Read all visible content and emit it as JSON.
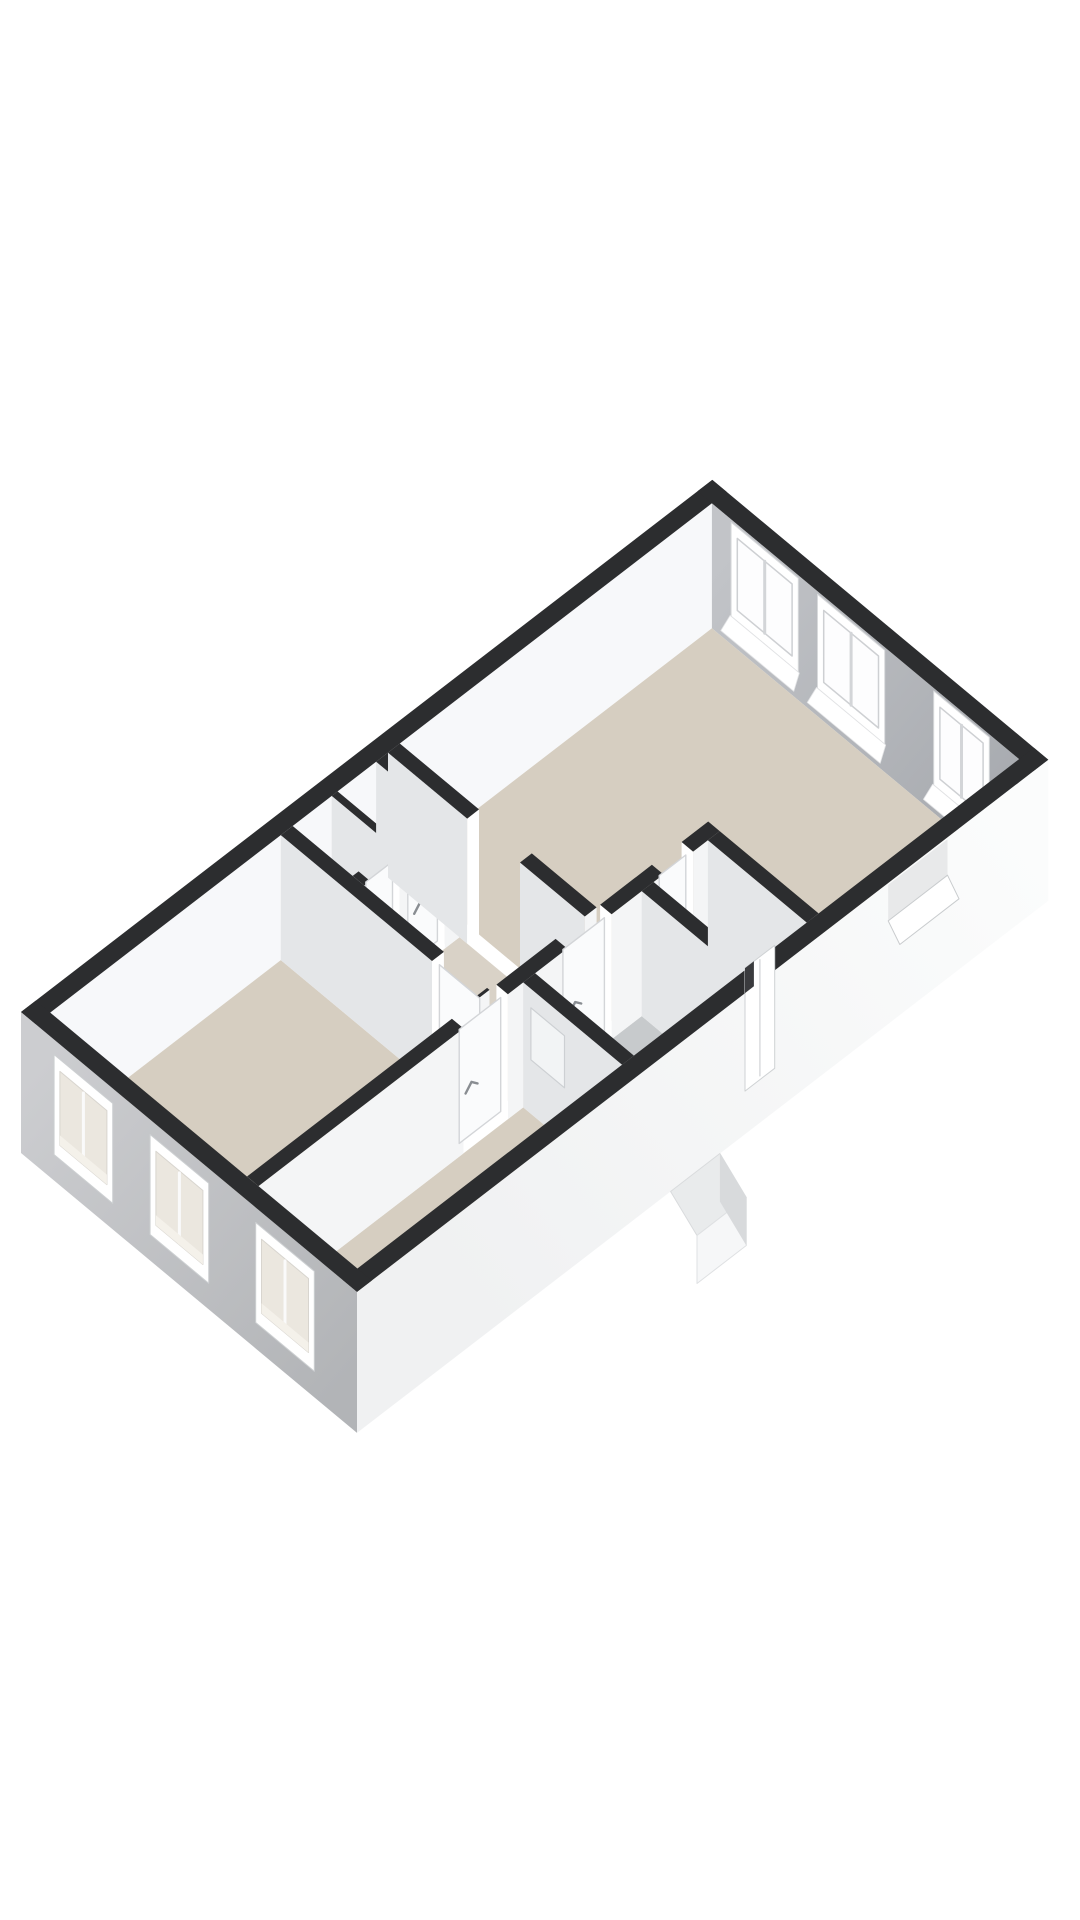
{
  "page": {
    "background": "#ffffff",
    "kind": "3d-floor-plan-render"
  },
  "scene": {
    "projection": {
      "origin": [
        21,
        1137
      ],
      "ux": [
        49.38,
        -38.01
      ],
      "vy": [
        48.0,
        39.98
      ]
    },
    "metrics": {
      "topZ": -125,
      "floorZ": 0,
      "extBottomZ": 16,
      "leafTop": -118,
      "leafBottom": -4
    },
    "colors": {
      "wallTop": "#2c2d2f",
      "nwFace": "#f7f8fa",
      "neFace": "#a6a9ae",
      "neFaceLight": "#c2c4c8",
      "swFace": "#b2b4b7",
      "swFaceLight": "#cccdd0",
      "seFace": "#fbfcfc",
      "seFaceShade": "#f0f1f2",
      "intFaceSE": "#f4f5f6",
      "intFaceSW": "#e4e6e8",
      "floorBeige": "#d6cec1",
      "floorHall": "#d9d2c7",
      "floorBath": "#c7cacc",
      "floorCloset": "#ededee",
      "glass": "#fdfdfe",
      "paneGlass": "#f2f4f5",
      "leaf": "#fafbfc",
      "leafLine": "#d3d5d8",
      "handle": "#898d92",
      "stepTop": "#e9ebec",
      "stepFace": "#f6f7f8",
      "stepSide": "#d8dadc",
      "swWinInner": "#ebe7df",
      "jamb": "#ffffff",
      "nicheBack": "#e8e9ea",
      "sill": "#ffffff"
    },
    "exterior": {
      "nw": {
        "u": [
          0,
          14
        ],
        "v": [
          0,
          0.3
        ]
      },
      "ne": {
        "u": [
          13.7,
          14
        ],
        "v": [
          0,
          7
        ]
      },
      "se": {
        "u": [
          0,
          14
        ],
        "v": [
          6.7,
          7.0
        ]
      },
      "sw": {
        "u": [
          0,
          0.3
        ],
        "v": [
          0,
          7
        ]
      }
    },
    "rooms": [
      {
        "name": "bedroom-1-floor",
        "color": "floorBeige",
        "poly": [
          [
            0.3,
            0.3
          ],
          [
            4.97,
            0.3
          ],
          [
            4.97,
            4.4
          ],
          [
            0.3,
            4.4
          ]
        ]
      },
      {
        "name": "closet-a-floor",
        "color": "floorCloset",
        "poly": [
          [
            5.21,
            0.3
          ],
          [
            6.0,
            0.3
          ],
          [
            6.0,
            1.55
          ],
          [
            5.21,
            1.55
          ]
        ]
      },
      {
        "name": "closet-b-floor",
        "color": "floorCloset",
        "poly": [
          [
            6.12,
            0.3
          ],
          [
            6.9,
            0.3
          ],
          [
            6.9,
            1.55
          ],
          [
            6.12,
            1.55
          ]
        ]
      },
      {
        "name": "hallway-floor",
        "color": "floorHall",
        "poly": [
          [
            5.21,
            1.79
          ],
          [
            7.14,
            1.79
          ],
          [
            7.14,
            4.4
          ],
          [
            5.21,
            4.4
          ]
        ]
      },
      {
        "name": "living-room-floor",
        "color": "floorBeige",
        "poly": [
          [
            7.38,
            0.3
          ],
          [
            13.7,
            0.3
          ],
          [
            13.7,
            6.7
          ],
          [
            9.64,
            6.7
          ],
          [
            9.64,
            4.4
          ],
          [
            7.38,
            4.4
          ]
        ]
      },
      {
        "name": "bedroom-2-floor",
        "color": "floorBeige",
        "poly": [
          [
            0.3,
            4.64
          ],
          [
            5.66,
            4.64
          ],
          [
            5.66,
            6.7
          ],
          [
            0.3,
            6.7
          ]
        ]
      },
      {
        "name": "bathroom-floor",
        "color": "floorBath",
        "poly": [
          [
            5.9,
            4.64
          ],
          [
            8.06,
            4.64
          ],
          [
            8.06,
            6.7
          ],
          [
            5.9,
            6.7
          ]
        ]
      },
      {
        "name": "toilet-floor",
        "color": "floorBath",
        "poly": [
          [
            8.3,
            4.64
          ],
          [
            9.4,
            4.64
          ],
          [
            9.4,
            6.7
          ],
          [
            8.3,
            6.7
          ]
        ]
      }
    ],
    "intWalls": [
      {
        "name": "closet-separator-wall",
        "dir": "v",
        "u": [
          6.0,
          6.12
        ],
        "v": [
          0.3,
          1.55
        ]
      },
      {
        "name": "closet-east-wall",
        "dir": "v",
        "u": [
          6.9,
          7.14
        ],
        "v": [
          0.3,
          1.79
        ]
      },
      {
        "name": "closet-front-wall",
        "dir": "u",
        "v": [
          1.55,
          1.79
        ],
        "u": [
          5.21,
          6.9
        ],
        "leaves": [
          {
            "name": "closet-a-door",
            "a": [
              5.33,
              5.93
            ]
          },
          {
            "name": "closet-b-door",
            "a": [
              6.18,
              6.84
            ]
          }
        ]
      },
      {
        "name": "hall-living-wall",
        "dir": "v",
        "u": [
          7.14,
          7.38
        ],
        "v": [
          0.3,
          4.4
        ],
        "openings": [
          {
            "a": [
              1.95,
              3.05
            ]
          }
        ]
      },
      {
        "name": "bedroom-1-wall",
        "dir": "v",
        "u": [
          4.97,
          5.21
        ],
        "v": [
          0.3,
          4.4
        ],
        "openings": [
          {
            "a": [
              3.45,
              4.35
            ]
          }
        ],
        "leaves": [
          {
            "name": "bedroom-1-door",
            "a": [
              3.45,
              4.35
            ]
          }
        ]
      },
      {
        "name": "corridor-wall",
        "dir": "u",
        "v": [
          4.4,
          4.64
        ],
        "u": [
          0.3,
          9.64
        ],
        "openings": [
          {
            "a": [
              4.45,
              5.35
            ]
          },
          {
            "a": [
              6.55,
              7.45
            ]
          },
          {
            "a": [
              8.5,
              9.1
            ]
          }
        ],
        "leaves": [
          {
            "name": "bedroom-2-door",
            "a": [
              4.45,
              5.35
            ]
          },
          {
            "name": "bathroom-door",
            "a": [
              6.55,
              7.45
            ]
          },
          {
            "name": "toilet-door",
            "a": [
              8.5,
              9.1
            ]
          }
        ]
      },
      {
        "name": "bedroom-2-bathroom-wall",
        "dir": "v",
        "u": [
          5.66,
          5.9
        ],
        "v": [
          4.64,
          6.7
        ],
        "panes": [
          {
            "v": [
              4.8,
              5.5
            ],
            "z": [
              -106,
              -54
            ]
          }
        ]
      },
      {
        "name": "bathroom-toilet-wall",
        "dir": "v",
        "u": [
          8.06,
          8.3
        ],
        "v": [
          4.64,
          6.7
        ]
      },
      {
        "name": "toilet-living-wall",
        "dir": "v",
        "u": [
          9.4,
          9.64
        ],
        "v": [
          4.64,
          6.7
        ]
      }
    ],
    "neWindows": [
      {
        "name": "living-room-window-1",
        "v": [
          0.78,
          2.02
        ]
      },
      {
        "name": "living-room-window-2",
        "v": [
          2.58,
          3.82
        ]
      },
      {
        "name": "living-room-window-3",
        "v": [
          5.0,
          6.0
        ]
      }
    ],
    "swWindows": [
      {
        "name": "bedroom-1-window-1",
        "v": [
          0.75,
          1.85
        ]
      },
      {
        "name": "bedroom-1-window-2",
        "v": [
          2.75,
          3.85
        ]
      },
      {
        "name": "bedroom-2-window",
        "v": [
          4.95,
          6.05
        ]
      }
    ],
    "seFeatures": {
      "niche": {
        "name": "living-room-sill-niche",
        "u": [
          11.05,
          12.25
        ]
      },
      "doorFrame": {
        "name": "entrance-door-frame",
        "u": [
          8.15,
          8.75
        ]
      },
      "steps": {
        "name": "entrance-steps",
        "u": [
          6.35,
          7.35
        ]
      }
    }
  }
}
